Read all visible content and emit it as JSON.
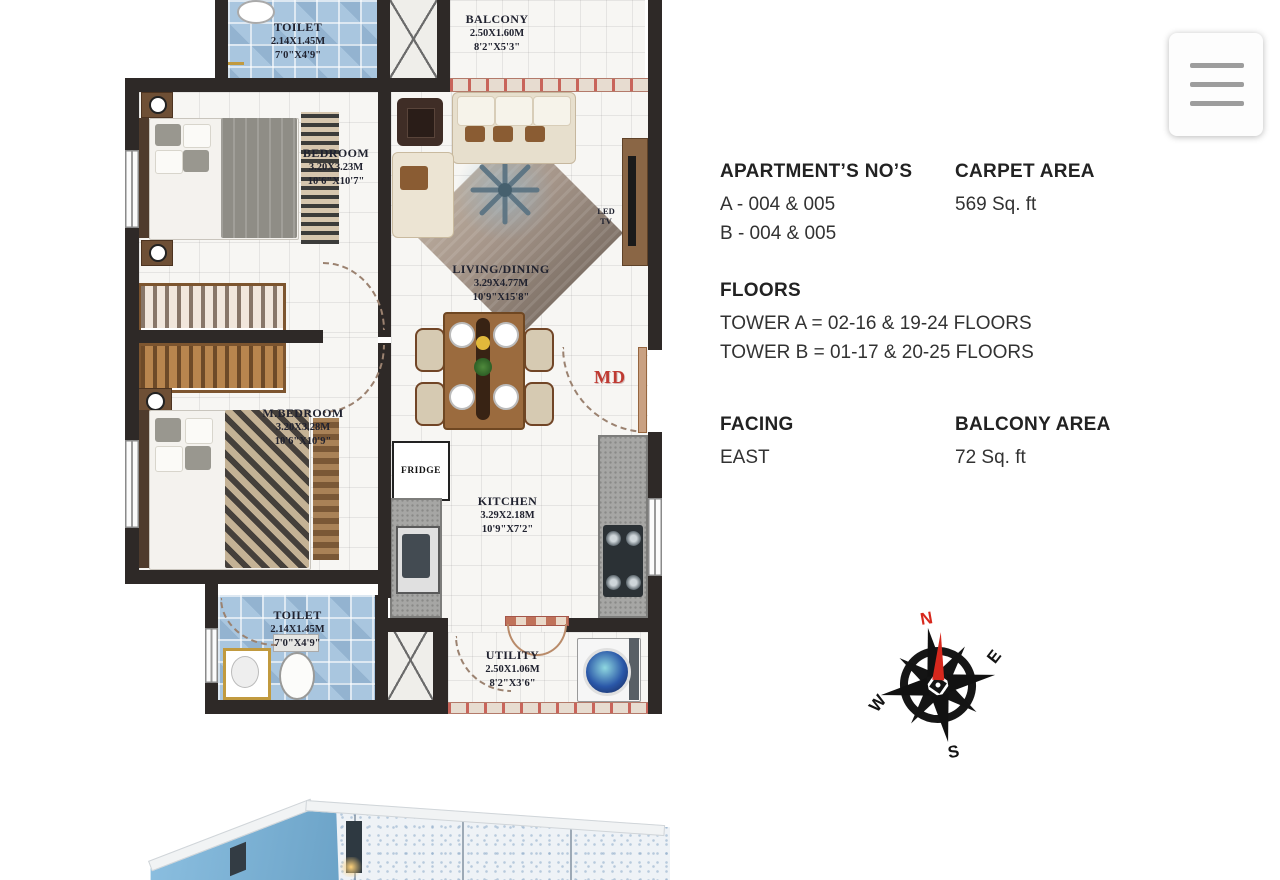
{
  "details": {
    "apartments_title": "APARTMENT’S NO’S",
    "apartments_a": "A - 004 & 005",
    "apartments_b": "B - 004 & 005",
    "carpet_title": "CARPET AREA",
    "carpet_value": "569 Sq. ft",
    "floors_title": "FLOORS",
    "floors_tower_a": "TOWER A = 02-16 & 19-24 FLOORS",
    "floors_tower_b": "TOWER B = 01-17 & 20-25 FLOORS",
    "facing_title": "FACING",
    "facing_value": "EAST",
    "balcony_title": "BALCONY AREA",
    "balcony_value": "72 Sq. ft"
  },
  "plan": {
    "toilet_top": {
      "name": "TOILET",
      "m": "2.14X1.45M",
      "ft": "7'0\"X4'9\""
    },
    "balcony": {
      "name": "BALCONY",
      "m": "2.50X1.60M",
      "ft": "8'2\"X5'3\""
    },
    "bedroom": {
      "name": "BEDROOM",
      "m": "3.20X3.23M",
      "ft": "10'6\"X10'7\""
    },
    "living": {
      "name": "LIVING/DINING",
      "m": "3.29X4.77M",
      "ft": "10'9\"X15'8\""
    },
    "master_bedroom": {
      "name": "M.BEDROOM",
      "m": "3.20X3.28M",
      "ft": "10'6\"X10'9\""
    },
    "kitchen": {
      "name": "KITCHEN",
      "m": "3.29X2.18M",
      "ft": "10'9\"X7'2\""
    },
    "toilet_bottom": {
      "name": "TOILET",
      "m": "2.14X1.45M",
      "ft": "7'0\"X4'9\""
    },
    "utility": {
      "name": "UTILITY",
      "m": "2.50X1.06M",
      "ft": "8'2\"X3'6\""
    },
    "fridge_label": "FRIDGE",
    "led_label": "LED",
    "tv_label": "TV",
    "main_door_label": "MD"
  },
  "compass": {
    "north": "N",
    "east": "E",
    "south": "S",
    "west": "W"
  },
  "colors": {
    "accent_red": "#c0392b",
    "wall_dark": "#2e2927",
    "tile_blue": "#a9c6df"
  }
}
